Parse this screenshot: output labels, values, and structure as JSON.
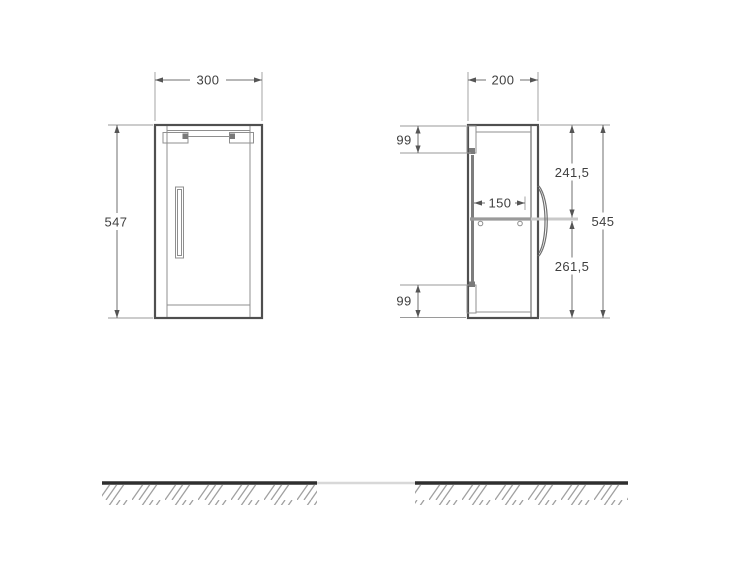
{
  "front_view": {
    "width": "300",
    "height": "547"
  },
  "side_view": {
    "depth": "200",
    "top_offset": "99",
    "bottom_offset": "99",
    "shelf_depth": "150",
    "upper_span": "241,5",
    "lower_span": "261,5",
    "total_height": "545"
  },
  "colors": {
    "outline": "#4f4f4f",
    "dimension_lines": "#6f6f6f",
    "text": "#3f3f3f",
    "ground_line": "#2e2e2e",
    "hatch": "#a0a0a0",
    "shelf": "#9a9a9a",
    "background": "#ffffff"
  }
}
